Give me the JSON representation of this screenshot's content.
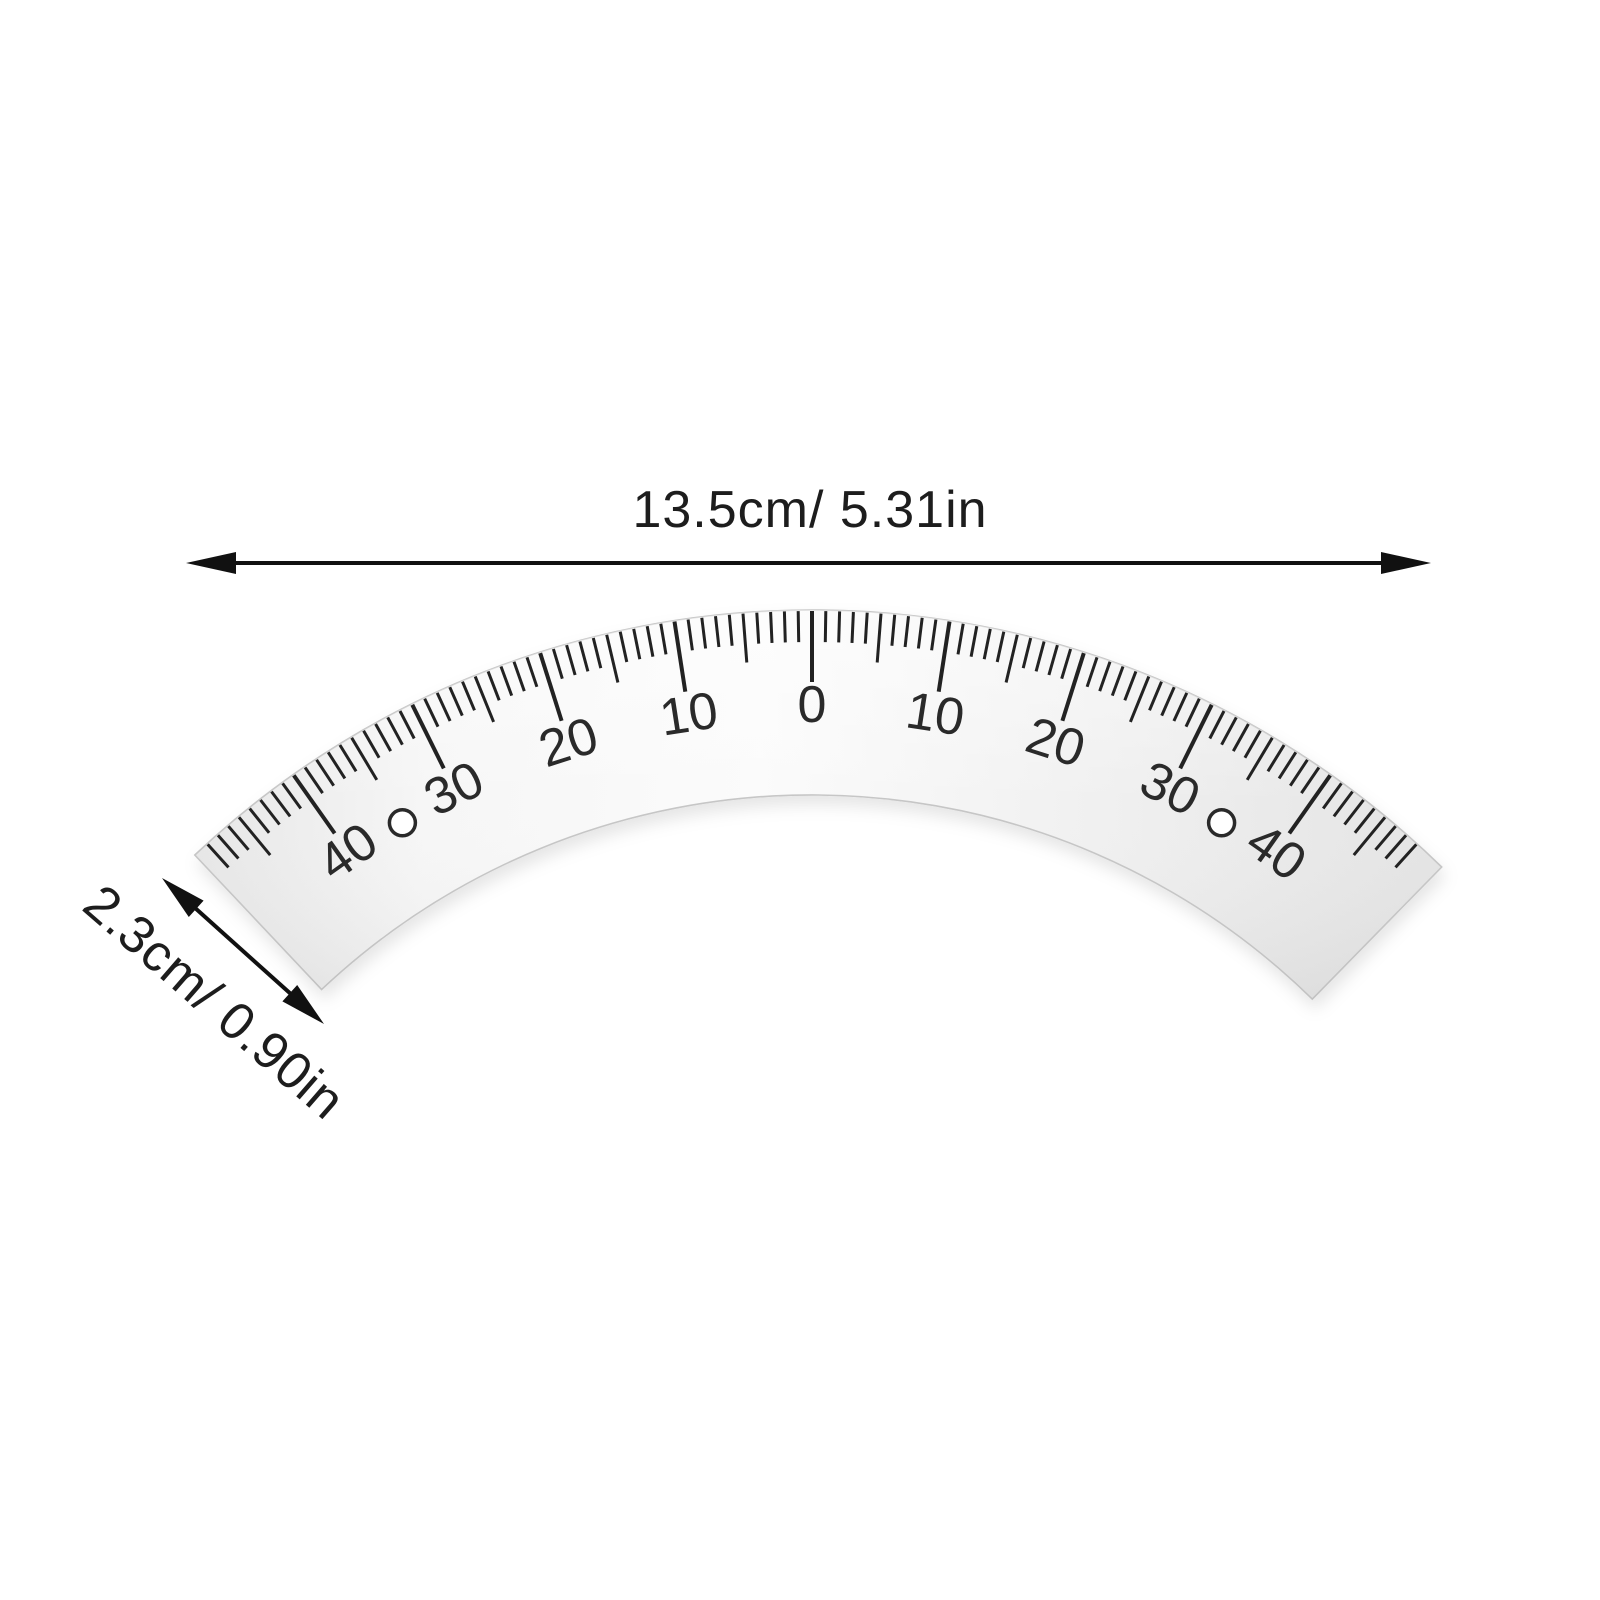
{
  "product": {
    "name": "arc-protractor-scale-ruler",
    "length_label": "13.5cm/ 5.31in",
    "width_label": "2.3cm/ 0.90in"
  },
  "scale": {
    "major_labels": [
      "40",
      "30",
      "20",
      "10",
      "0",
      "10",
      "20",
      "30",
      "40"
    ],
    "major_values": [
      -40,
      -30,
      -20,
      -10,
      0,
      10,
      20,
      30,
      40
    ],
    "tick_min": -48,
    "tick_max": 48,
    "minor_step": 1,
    "medium_step": 5,
    "major_step": 10,
    "hole_values": [
      -35,
      35
    ]
  },
  "colors": {
    "background": "#ffffff",
    "metal_light": "#fbfbfb",
    "metal_mid": "#f1f1f1",
    "metal_dark": "#e4e4e4",
    "metal_edge": "#c6c6c6",
    "ink": "#2b2b2b",
    "annotation": "#111111"
  }
}
